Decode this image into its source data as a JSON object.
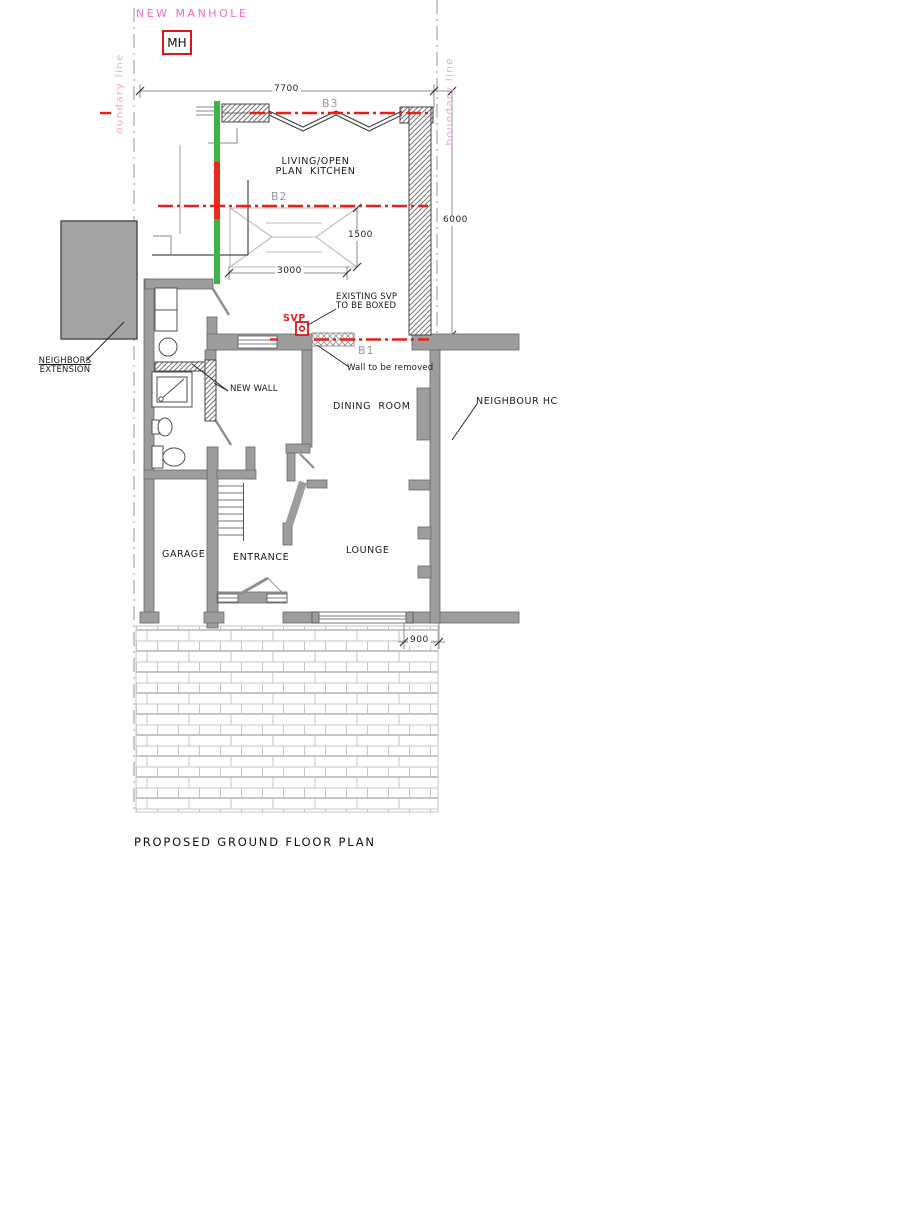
{
  "title": "PROPOSED GROUND FLOOR PLAN",
  "annotations": {
    "new_manhole": "NEW MANHOLE",
    "manhole_tag": "MH",
    "boundary_left": "oundary line",
    "boundary_right": "boundary line",
    "neighbour_house": "NEIGHBOUR HC",
    "neighbors_extension": [
      "NEIGHBORS",
      "EXTENSION"
    ],
    "svp": "SVP",
    "svp_note": [
      "EXISTING SVP",
      "TO BE BOXED"
    ],
    "wall_removed": "Wall to be removed",
    "new_wall": "NEW WALL"
  },
  "rooms": {
    "kitchen": [
      "LIVING/OPEN",
      "PLAN  KITCHEN"
    ],
    "dining": "DINING  ROOM",
    "lounge": "LOUNGE",
    "garage": "GARAGE",
    "entrance": "ENTRANCE"
  },
  "beams": {
    "b1": "B1",
    "b2": "B2",
    "b3": "B3"
  },
  "dimensions": {
    "rear_width": "7700",
    "side_depth": "6000",
    "island_length": "3000",
    "island_width": "1500",
    "front_offset": "900"
  },
  "colors": {
    "beam_line_red": "#e8201a",
    "drain_green": "#3bb44a",
    "drain_red": "#e8291c",
    "boundary_pink": "#ee6fc4",
    "wall_gray": "#9d9d9d",
    "label_gray": "#9a9a9a"
  }
}
